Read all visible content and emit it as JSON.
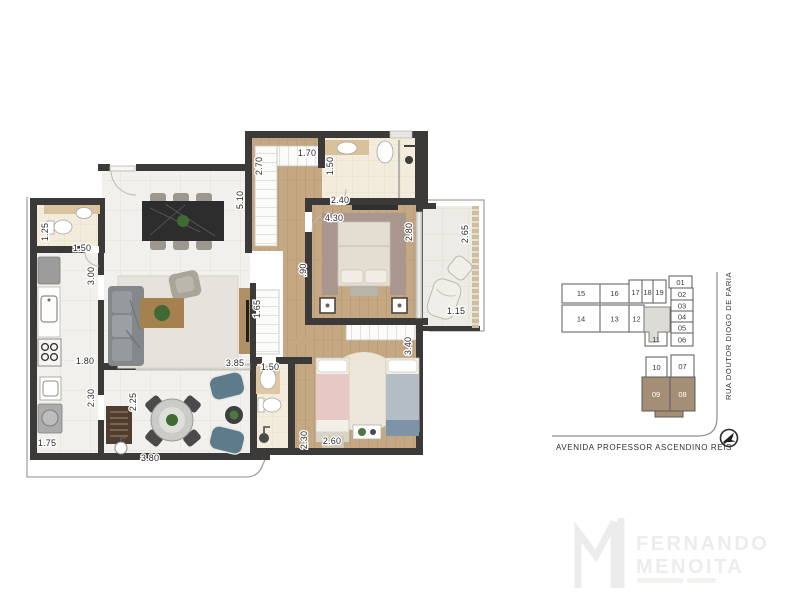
{
  "plan": {
    "dims": [
      "1.25",
      "1.50",
      "3.00",
      "1.80",
      "2.30",
      "1.75",
      "2.25",
      "3.80",
      "5.10",
      "2.70",
      "1.70",
      "1.50",
      "2.40",
      "4.30",
      "2.80",
      "2.65",
      "1.15",
      ".90",
      "1.65",
      "3.85",
      "1.50",
      "2.30",
      "2.60",
      "3.40"
    ]
  },
  "keyplan": {
    "units": [
      "01",
      "02",
      "03",
      "04",
      "05",
      "06",
      "07",
      "08",
      "09",
      "10",
      "11",
      "12",
      "13",
      "14",
      "15",
      "16",
      "17",
      "18",
      "19"
    ],
    "highlighted_units": [
      "08",
      "09"
    ],
    "streets": {
      "right": "RUA DOUTOR DIOGO DE FARIA",
      "bottom": "AVENIDA PROFESSOR ASCENDINO REIS"
    }
  },
  "logo": {
    "name_line1": "FERNANDO",
    "name_line2": "MENOITA"
  },
  "colors": {
    "wall": "#3b3a38",
    "tile_floor": "#f2f0ec",
    "wood_floor": "#c3a883",
    "bath_floor": "#f3ebdc",
    "keyplan_highlight": "#a58e76",
    "keyplan_core": "#dcdbd6"
  }
}
